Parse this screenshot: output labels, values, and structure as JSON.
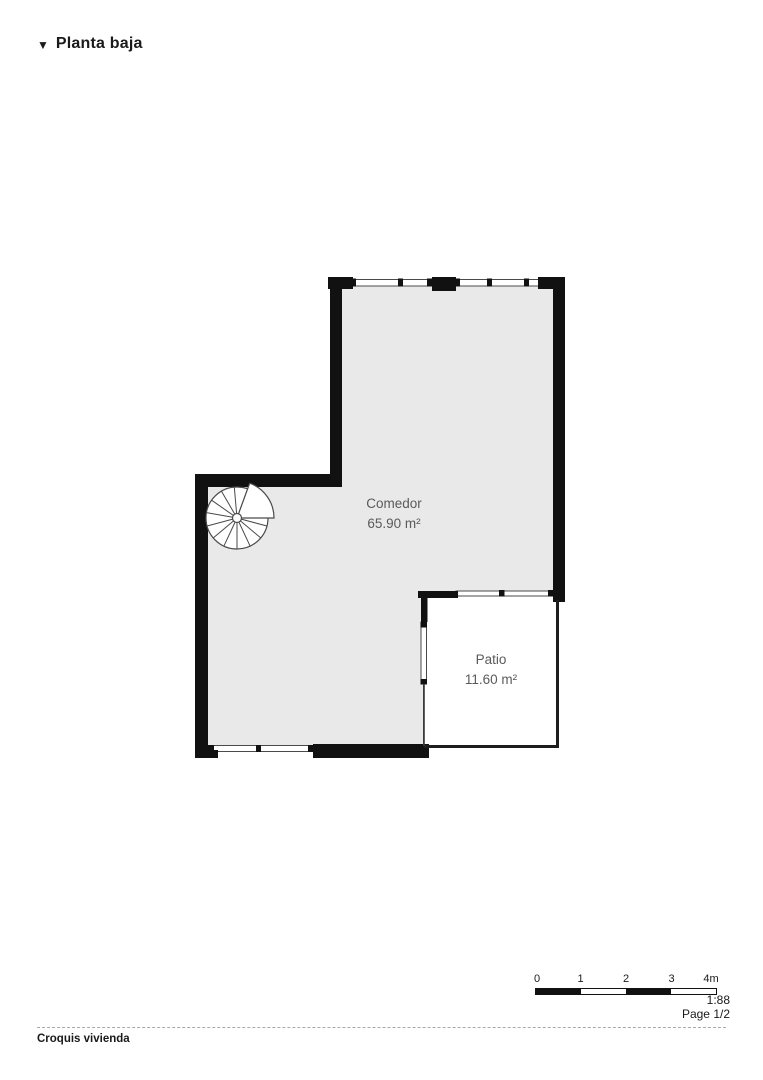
{
  "header": {
    "marker": "▼",
    "title": "Planta baja"
  },
  "plan": {
    "rooms": [
      {
        "name": "Comedor",
        "area": "65.90 m²"
      },
      {
        "name": "Patio",
        "area": "11.60 m²"
      }
    ]
  },
  "scale_bar": {
    "ticks": [
      "0",
      "1",
      "2",
      "3",
      "4m"
    ],
    "scale": "1:88",
    "page": "Page 1/2"
  },
  "footer": {
    "label": "Croquis vivienda"
  },
  "colors": {
    "wall": "#111111",
    "floor_fill": "#e9e9e9",
    "window_line": "#4a4a4a",
    "label_text": "#595a5c"
  }
}
